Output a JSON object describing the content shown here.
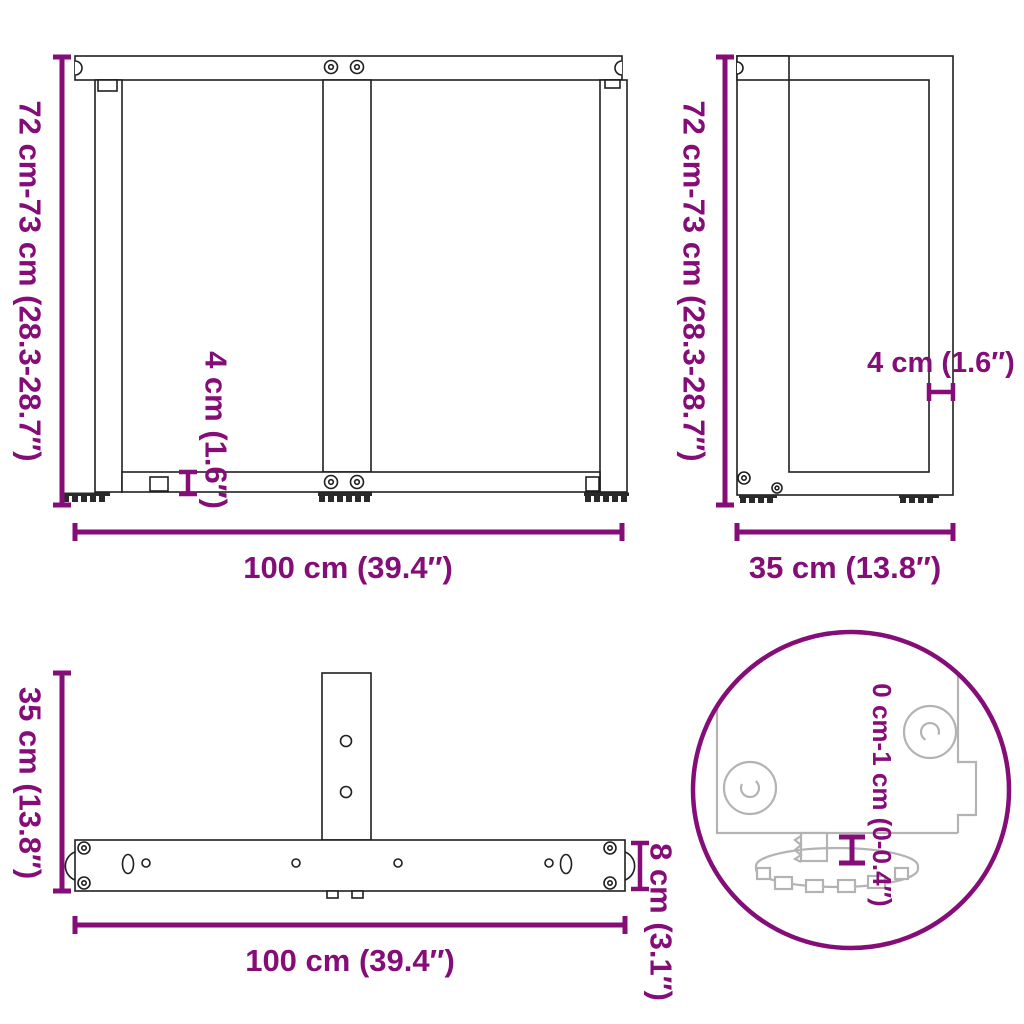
{
  "diagram": {
    "type": "product-dimension-diagram",
    "subject": "T-shaped table leg frame, three orthographic views plus adjustable-foot detail",
    "colors": {
      "dimension": "#850d78",
      "drawing_line": "#1f1f1f",
      "detail_line": "#b3b3b3",
      "background": "#ffffff"
    },
    "views": {
      "front": {
        "height_label": "72 cm-73 cm (28.3-28.7″)",
        "width_label": "100 cm (39.4″)",
        "rail_thickness_label": "4 cm (1.6″)"
      },
      "side": {
        "height_label": "72 cm-73 cm (28.3-28.7″)",
        "depth_label": "35 cm (13.8″)",
        "post_thickness_label": "4 cm (1.6″)"
      },
      "top": {
        "depth_label": "35 cm (13.8″)",
        "width_label": "100 cm (39.4″)",
        "bar_width_label": "8 cm (3.1″)"
      },
      "detail": {
        "foot_adjustment_label": "0 cm-1 cm (0-0.4″)"
      }
    }
  }
}
